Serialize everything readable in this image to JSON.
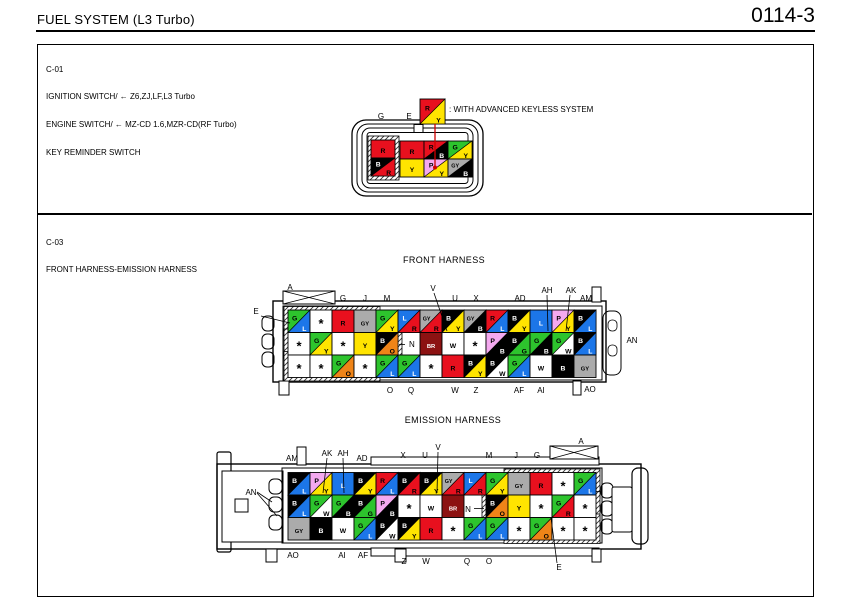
{
  "header": {
    "title": "FUEL SYSTEM (L3 Turbo)",
    "page_number": "0114-3"
  },
  "colors": {
    "B": "#000000",
    "L": "#1c76e8",
    "R": "#e8101e",
    "Y": "#ffe400",
    "G": "#2dc42d",
    "GY": "#ababab",
    "P": "#f4a9ef",
    "O": "#ef8418",
    "BR": "#8c1212",
    "W": "#ffffff",
    "*": "#ffffff"
  },
  "c01": {
    "code": "C-01",
    "description_lines": [
      "IGNITION SWITCH/ ← Z6,ZJ,LF,L3 Turbo",
      "ENGINE SWITCH/ ← MZ-CD 1.6,MZR-CD(RF Turbo)",
      "KEY REMINDER SWITCH"
    ],
    "legend": {
      "cell": "R/Y",
      "text": ": WITH ADVANCED KEYLESS SYSTEM"
    },
    "pin_labels": [
      {
        "t": "G",
        "x": 381,
        "y": 119
      },
      {
        "t": "E",
        "x": 409,
        "y": 119
      }
    ],
    "left_cells": [
      "R",
      "B/R"
    ],
    "grid": [
      [
        "R",
        "R/B",
        "G/Y"
      ],
      [
        "Y",
        "P/Y",
        "GY/B"
      ]
    ]
  },
  "c03": {
    "code": "C-03",
    "description": "FRONT HARNESS-EMISSION HARNESS",
    "front": {
      "title": "FRONT HARNESS",
      "rows": [
        [
          "G/L",
          "*",
          "R",
          "GY",
          "G/Y",
          "L/R",
          "GY/R",
          "B/Y",
          "GY/B",
          "R/L",
          "B/Y",
          "L",
          "P/Y",
          "B/L"
        ],
        [
          "*",
          "G/Y",
          "*",
          "Y",
          "B/O",
          "",
          "BR",
          "W",
          "*",
          "P/B",
          "B/G",
          "G/B",
          "G/W",
          "B/L"
        ],
        [
          "*",
          "*",
          "G/O",
          "*",
          "G/L",
          "G/L",
          "*",
          "R",
          "B/Y",
          "B/W",
          "G/L",
          "W",
          "B",
          "GY"
        ]
      ],
      "hatched_cols": [
        [
          0,
          3
        ],
        [
          0,
          4
        ],
        [
          0,
          3
        ]
      ],
      "labels": [
        {
          "t": "A",
          "x": 290,
          "y": 290
        },
        {
          "t": "G",
          "x": 343,
          "y": 301
        },
        {
          "t": "J",
          "x": 365,
          "y": 301
        },
        {
          "t": "M",
          "x": 387,
          "y": 301
        },
        {
          "t": "V",
          "x": 433,
          "y": 291
        },
        {
          "t": "U",
          "x": 455,
          "y": 301
        },
        {
          "t": "X",
          "x": 476,
          "y": 301
        },
        {
          "t": "AD",
          "x": 520,
          "y": 301
        },
        {
          "t": "AH",
          "x": 547,
          "y": 293
        },
        {
          "t": "AK",
          "x": 571,
          "y": 293
        },
        {
          "t": "AM",
          "x": 586,
          "y": 301
        },
        {
          "t": "O",
          "x": 390,
          "y": 393
        },
        {
          "t": "Q",
          "x": 411,
          "y": 393
        },
        {
          "t": "W",
          "x": 455,
          "y": 393
        },
        {
          "t": "Z",
          "x": 476,
          "y": 393
        },
        {
          "t": "AF",
          "x": 519,
          "y": 393
        },
        {
          "t": "AI",
          "x": 541,
          "y": 393
        },
        {
          "t": "AO",
          "x": 590,
          "y": 392
        },
        {
          "t": "E",
          "x": 256,
          "y": 314
        },
        {
          "t": "AN",
          "x": 632,
          "y": 343
        },
        {
          "t": "N",
          "x": 409,
          "y": 347,
          "a": "start"
        }
      ]
    },
    "emission": {
      "title": "EMISSION HARNESS",
      "rows": [
        [
          "B/L",
          "P/Y",
          "L",
          "B/Y",
          "R/L",
          "B/R",
          "B/Y",
          "GY/R",
          "L/R",
          "G/Y",
          "GY",
          "R",
          "*",
          "G/L"
        ],
        [
          "B/L",
          "G/W",
          "G/B",
          "B/G",
          "P/B",
          "*",
          "W",
          "BR",
          "",
          "B/O",
          "Y",
          "*",
          "G/R",
          "*"
        ],
        [
          "GY",
          "B",
          "W",
          "G/L",
          "B/W",
          "B/Y",
          "R",
          "*",
          "G/L",
          "G/L",
          "*",
          "G/O",
          "*",
          "*"
        ]
      ],
      "hatched_cols": [
        [
          10,
          13
        ],
        [
          9,
          13
        ],
        [
          10,
          13
        ]
      ],
      "labels": [
        {
          "t": "AM",
          "x": 292,
          "y": 461
        },
        {
          "t": "AK",
          "x": 327,
          "y": 456
        },
        {
          "t": "AH",
          "x": 343,
          "y": 456
        },
        {
          "t": "AD",
          "x": 362,
          "y": 461
        },
        {
          "t": "X",
          "x": 403,
          "y": 458
        },
        {
          "t": "U",
          "x": 425,
          "y": 458
        },
        {
          "t": "V",
          "x": 438,
          "y": 450
        },
        {
          "t": "M",
          "x": 489,
          "y": 458
        },
        {
          "t": "J",
          "x": 516,
          "y": 458
        },
        {
          "t": "G",
          "x": 537,
          "y": 458
        },
        {
          "t": "A",
          "x": 581,
          "y": 444
        },
        {
          "t": "AO",
          "x": 293,
          "y": 558
        },
        {
          "t": "AI",
          "x": 342,
          "y": 558
        },
        {
          "t": "AF",
          "x": 363,
          "y": 558
        },
        {
          "t": "Z",
          "x": 404,
          "y": 564
        },
        {
          "t": "W",
          "x": 426,
          "y": 564
        },
        {
          "t": "Q",
          "x": 467,
          "y": 564
        },
        {
          "t": "O",
          "x": 489,
          "y": 564
        },
        {
          "t": "E",
          "x": 559,
          "y": 570
        },
        {
          "t": "AN",
          "x": 251,
          "y": 495
        },
        {
          "t": "N",
          "x": 468,
          "y": 512
        }
      ]
    }
  }
}
